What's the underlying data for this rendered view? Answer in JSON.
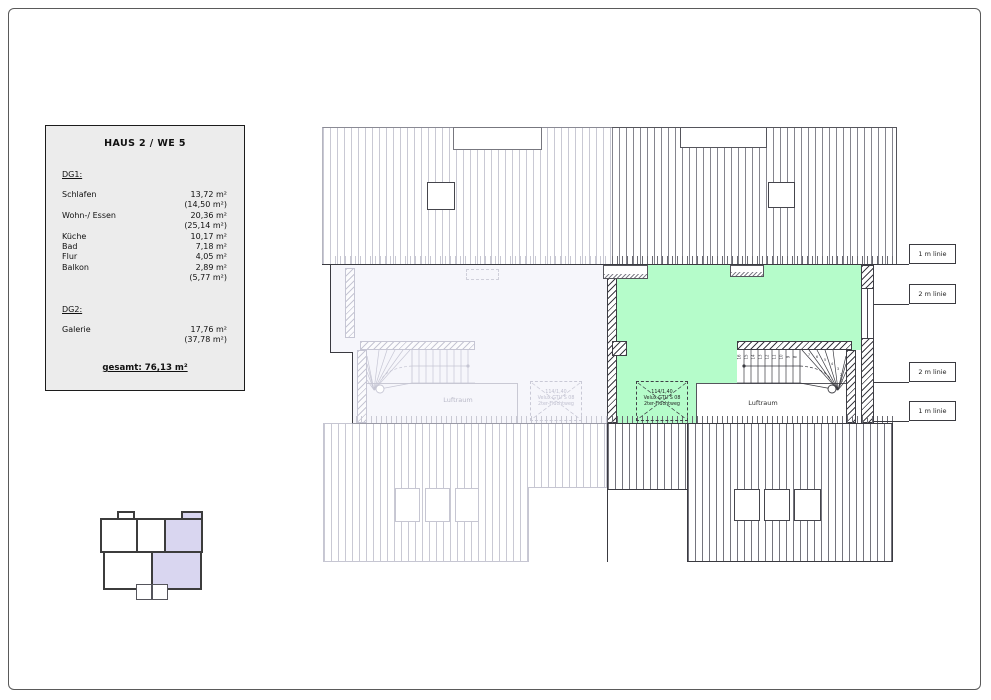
{
  "legend": {
    "title": "HAUS 2 / WE 5",
    "sections": [
      {
        "heading": "DG1:",
        "rows": [
          {
            "label": "Schlafen",
            "value": "13,72 m²",
            "paren": "(14,50 m²)"
          },
          {
            "label": "Wohn-/ Essen",
            "value": "20,36 m²",
            "paren": "(25,14 m²)"
          },
          {
            "label": "Küche",
            "value": "10,17 m²"
          },
          {
            "label": "Bad",
            "value": "7,18 m²"
          },
          {
            "label": "Flur",
            "value": "4,05 m²"
          },
          {
            "label": "Balkon",
            "value": "2,89 m²",
            "paren": "(5,77 m²)"
          }
        ]
      },
      {
        "heading": "DG2:",
        "rows": [
          {
            "label": "Galerie",
            "value": "17,76 m²",
            "paren": "(37,78 m²)"
          }
        ]
      }
    ],
    "total": "gesamt: 76,13 m²"
  },
  "plan": {
    "meter_lines": [
      "1 m linie",
      "2 m linie",
      "2 m linie",
      "1 m linie"
    ],
    "luftraum_right": "Luftraum",
    "luftraum_left": "Luftraum",
    "skylight_right": [
      "114/1,40",
      "Velux GTU S 08",
      "2ter-Fluchtweg"
    ],
    "skylight_left": [
      "114/1,40",
      "Velux GTU S 08",
      "2ter-Fluchtweg"
    ],
    "stairs": {
      "straight": [
        "16",
        "15",
        "14",
        "13",
        "12",
        "11",
        "10",
        "9",
        "8"
      ],
      "winder": [
        "7",
        "6",
        "5",
        "4",
        "3",
        "2",
        "1"
      ]
    },
    "colors": {
      "highlight": "#b5fcca",
      "adjacent": "#f6f6fb",
      "keyplan_highlight": "#d9d6f0"
    }
  }
}
